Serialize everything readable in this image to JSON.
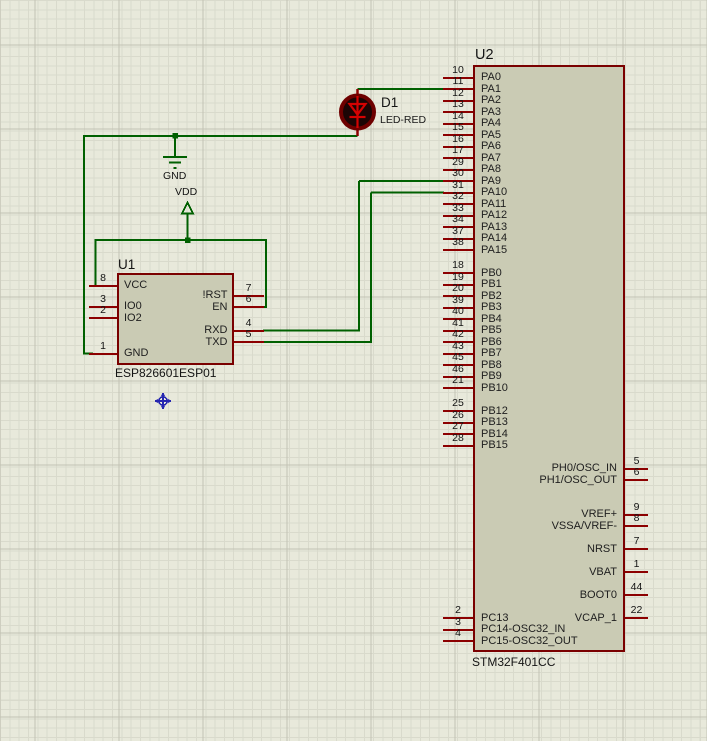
{
  "schematic": {
    "colors": {
      "wire": "#006000",
      "component_outline": "#7a0000",
      "component_fill": "#cacbb4",
      "led_glyph": "#d40202",
      "origin_marker": "#2626b0"
    },
    "power_labels": {
      "gnd": "GND",
      "vdd": "VDD"
    },
    "components": {
      "u2": {
        "ref": "U2",
        "value": "STM32F401CC",
        "pins": [
          {
            "name": "PA0",
            "number": "10",
            "side": "left",
            "slot": 0
          },
          {
            "name": "PA1",
            "number": "11",
            "side": "left",
            "slot": 1
          },
          {
            "name": "PA2",
            "number": "12",
            "side": "left",
            "slot": 2
          },
          {
            "name": "PA3",
            "number": "13",
            "side": "left",
            "slot": 3
          },
          {
            "name": "PA4",
            "number": "14",
            "side": "left",
            "slot": 4
          },
          {
            "name": "PA5",
            "number": "15",
            "side": "left",
            "slot": 5
          },
          {
            "name": "PA6",
            "number": "16",
            "side": "left",
            "slot": 6
          },
          {
            "name": "PA7",
            "number": "17",
            "side": "left",
            "slot": 7
          },
          {
            "name": "PA8",
            "number": "29",
            "side": "left",
            "slot": 8
          },
          {
            "name": "PA9",
            "number": "30",
            "side": "left",
            "slot": 9
          },
          {
            "name": "PA10",
            "number": "31",
            "side": "left",
            "slot": 10
          },
          {
            "name": "PA11",
            "number": "32",
            "side": "left",
            "slot": 11
          },
          {
            "name": "PA12",
            "number": "33",
            "side": "left",
            "slot": 12
          },
          {
            "name": "PA13",
            "number": "34",
            "side": "left",
            "slot": 13
          },
          {
            "name": "PA14",
            "number": "37",
            "side": "left",
            "slot": 14
          },
          {
            "name": "PA15",
            "number": "38",
            "side": "left",
            "slot": 15
          },
          {
            "name": "PB0",
            "number": "18",
            "side": "left",
            "slot": 17
          },
          {
            "name": "PB1",
            "number": "19",
            "side": "left",
            "slot": 18
          },
          {
            "name": "PB2",
            "number": "20",
            "side": "left",
            "slot": 19
          },
          {
            "name": "PB3",
            "number": "39",
            "side": "left",
            "slot": 20
          },
          {
            "name": "PB4",
            "number": "40",
            "side": "left",
            "slot": 21
          },
          {
            "name": "PB5",
            "number": "41",
            "side": "left",
            "slot": 22
          },
          {
            "name": "PB6",
            "number": "42",
            "side": "left",
            "slot": 23
          },
          {
            "name": "PB7",
            "number": "43",
            "side": "left",
            "slot": 24
          },
          {
            "name": "PB8",
            "number": "45",
            "side": "left",
            "slot": 25
          },
          {
            "name": "PB9",
            "number": "46",
            "side": "left",
            "slot": 26
          },
          {
            "name": "PB10",
            "number": "21",
            "side": "left",
            "slot": 27
          },
          {
            "name": "PB12",
            "number": "25",
            "side": "left",
            "slot": 29
          },
          {
            "name": "PB13",
            "number": "26",
            "side": "left",
            "slot": 30
          },
          {
            "name": "PB14",
            "number": "27",
            "side": "left",
            "slot": 31
          },
          {
            "name": "PB15",
            "number": "28",
            "side": "left",
            "slot": 32
          },
          {
            "name": "PC13",
            "number": "2",
            "side": "left",
            "slot": 47
          },
          {
            "name": "PC14-OSC32_IN",
            "number": "3",
            "side": "left",
            "slot": 48
          },
          {
            "name": "PC15-OSC32_OUT",
            "number": "4",
            "side": "left",
            "slot": 49
          },
          {
            "name": "PH0/OSC_IN",
            "number": "5",
            "side": "right",
            "slot": 34
          },
          {
            "name": "PH1/OSC_OUT",
            "number": "6",
            "side": "right",
            "slot": 35
          },
          {
            "name": "VREF+",
            "number": "9",
            "side": "right",
            "slot": 38
          },
          {
            "name": "VSSA/VREF-",
            "number": "8",
            "side": "right",
            "slot": 39
          },
          {
            "name": "NRST",
            "number": "7",
            "side": "right",
            "slot": 41
          },
          {
            "name": "VBAT",
            "number": "1",
            "side": "right",
            "slot": 43
          },
          {
            "name": "BOOT0",
            "number": "44",
            "side": "right",
            "slot": 45
          },
          {
            "name": "VCAP_1",
            "number": "22",
            "side": "right",
            "slot": 47
          }
        ]
      },
      "u1": {
        "ref": "U1",
        "value": "ESP826601ESP01",
        "pins": [
          {
            "name": "VCC",
            "number": "8",
            "side": "left",
            "y": 285.5
          },
          {
            "name": "IO0",
            "number": "3",
            "side": "left",
            "y": 306.5
          },
          {
            "name": "IO2",
            "number": "2",
            "side": "left",
            "y": 318
          },
          {
            "name": "GND",
            "number": "1",
            "side": "left",
            "y": 353.5
          },
          {
            "name": "!RST",
            "number": "7",
            "side": "right",
            "y": 295.5
          },
          {
            "name": "EN",
            "number": "6",
            "side": "right",
            "y": 307
          },
          {
            "name": "RXD",
            "number": "4",
            "side": "right",
            "y": 330.5
          },
          {
            "name": "TXD",
            "number": "5",
            "side": "right",
            "y": 342
          }
        ]
      },
      "d1": {
        "ref": "D1",
        "value": "LED-RED"
      }
    }
  }
}
